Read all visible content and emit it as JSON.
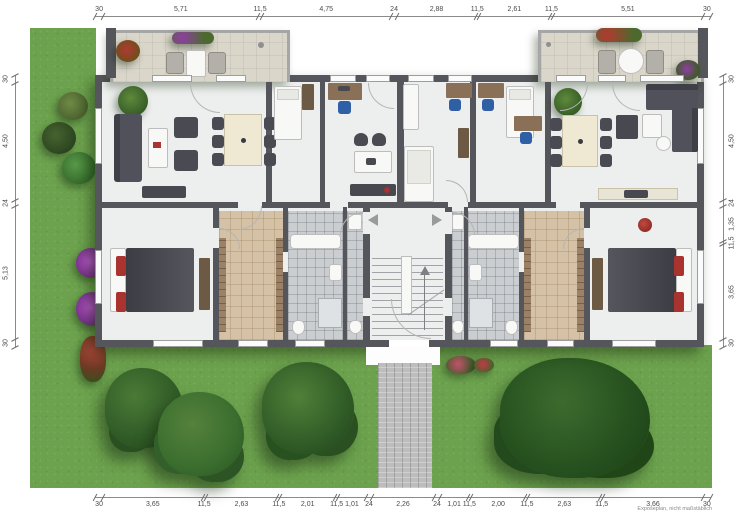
{
  "note": "Exposeplan, nicht maßstäblich",
  "dimensions": {
    "top": [
      "30",
      "5,71",
      "11,5",
      "4,75",
      "24",
      "2,88",
      "11,5",
      "2,61",
      "11,5",
      "5,51",
      "30"
    ],
    "bottom": [
      "30",
      "3,65",
      "11,5",
      "2,63",
      "11,5",
      "2,01",
      "11,5",
      "1,01",
      "24",
      "2,26",
      "24",
      "1,01",
      "11,5",
      "2,00",
      "11,5",
      "2,63",
      "11,5",
      "3,66",
      "30"
    ],
    "left": [
      "30",
      "4,50",
      "24",
      "5,13",
      "30"
    ],
    "right": [
      "30",
      "4,50",
      "24",
      "1,35",
      "11,5",
      "3,65",
      "30"
    ]
  },
  "colors": {
    "lawn": "#6ca24d",
    "wall": "#55565b",
    "floor": "#edefee",
    "terrace": "#dad6ca",
    "hall_floor": "#d5c1a5",
    "bath_floor": "#caced1",
    "path": "#bdbdbd",
    "furniture_dark": "#474850",
    "wood": "#8a7056",
    "accent_red": "#a8332f",
    "accent_blue": "#2f5fa5",
    "tree_green": "#2f5a26",
    "flower_purple": "#9b3fae"
  }
}
